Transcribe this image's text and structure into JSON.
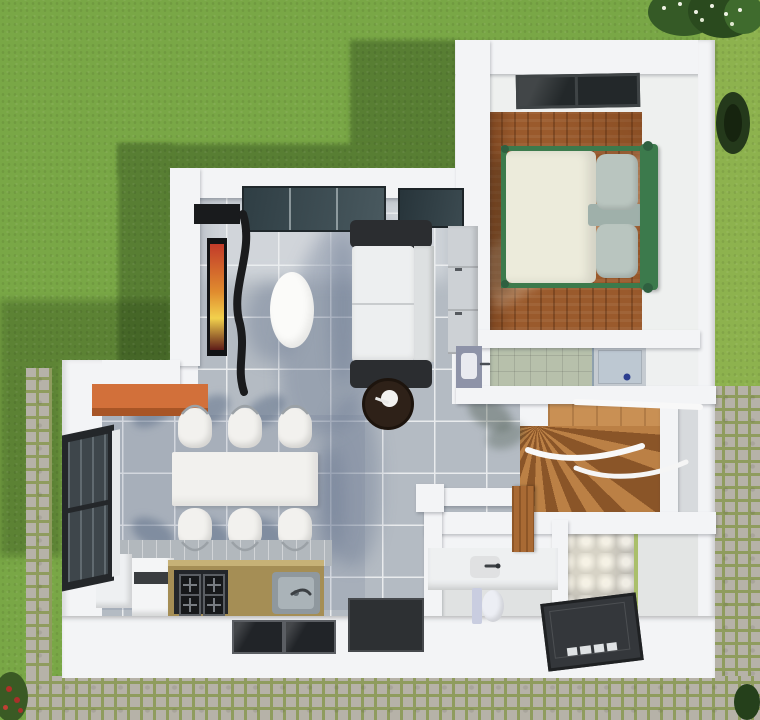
{
  "scene": {
    "title": "top-down-3d-floor-plan-render",
    "description": "Aerial 3D render of a single-storey house floor plan surrounded by a lawn, cobblestone paths and shrubs"
  },
  "palette": {
    "grass": "#79a746",
    "grass_light": "#8db24e",
    "grass_shadow": "#587e33",
    "paver": "#b6b2a8",
    "paver_gap": "#8f9c5e",
    "wall": "#f3f4f6",
    "wall_shade": "#d8dadd",
    "tile_floor": "#b4bbc3",
    "tile_grout": "#e9ebed",
    "wood_floor": "#9a5a2c",
    "stair_wood": "#bb8045",
    "stair_wood_dark": "#8a5528",
    "bed_frame_green": "#3c7a4c",
    "bed_duvet": "#ecebdb",
    "bed_pillow": "#b9c5bf",
    "sofa_dark": "#2b2d30",
    "sofa_light": "#edeff0",
    "glass_dark": "#2f3e44",
    "counter_tan": "#a58e55",
    "accent_orange": "#d2703a",
    "bath_tile": "#b7c0ab",
    "shower_tray_light": "#bdc8d2",
    "shower_tray_dark": "#34373b",
    "mat_dark": "#212428",
    "table_white": "#f2f1ee",
    "side_table_brown": "#2e2118",
    "tv_screen_warm": "#e08b2e"
  },
  "rooms": {
    "bedroom": {
      "furniture": [
        "double-bed",
        "skylight-window"
      ],
      "floor": "hardwood"
    },
    "bathroom_upper": {
      "fixtures": [
        "washbasin",
        "shower-tray"
      ],
      "floor": "green-tile"
    },
    "staircase": {
      "type": "winder-stairs",
      "material": "wood"
    },
    "living_room": {
      "furniture": [
        "sofa",
        "tv",
        "curved-tv-cabinet",
        "oval-coffee-table",
        "round-side-table",
        "wall-cabinet",
        "sliding-glass-door"
      ],
      "floor": "grey-tile"
    },
    "dining_area": {
      "furniture": [
        "dining-table",
        "breakfast-bar"
      ],
      "chairs": 6
    },
    "kitchen": {
      "fixtures": [
        "fridge",
        "cabinets",
        "gas-hob",
        "sink",
        "doormats"
      ],
      "hob_burners": 4
    },
    "bathroom_lower": {
      "fixtures": [
        "vanity",
        "toilet",
        "walk-in-shower"
      ],
      "wall": "quilted-3d-tile"
    },
    "exterior": {
      "features": [
        "lawn",
        "cobblestone-path",
        "stepping-stones",
        "flower-bed",
        "shrubs"
      ]
    }
  }
}
